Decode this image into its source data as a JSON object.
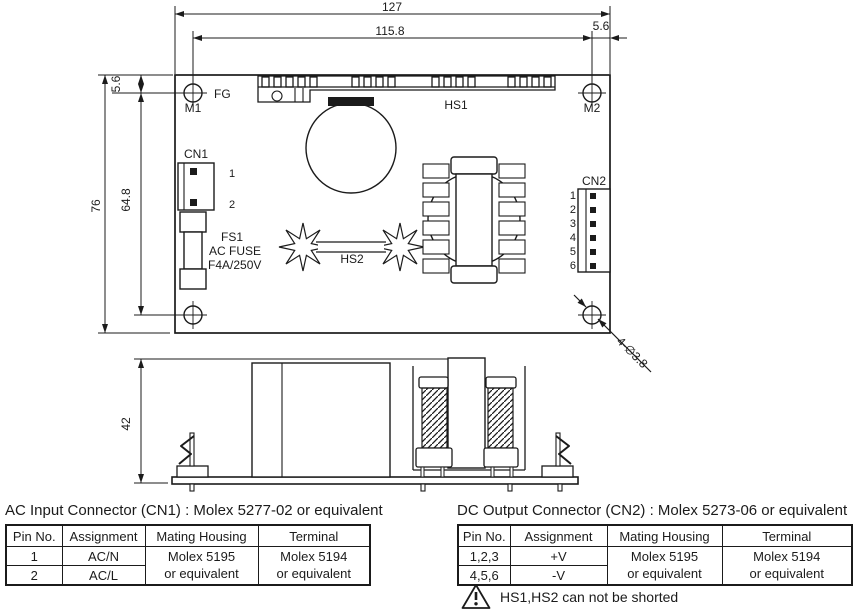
{
  "drawing": {
    "top_view": {
      "dims": {
        "total_width": "127",
        "hole_span_width": "115.8",
        "hole_offset_right": "5.6",
        "hole_offset_top": "5.6",
        "total_height": "76",
        "hole_span_height": "64.8"
      },
      "labels": {
        "fg": "FG",
        "m1": "M1",
        "m2": "M2",
        "cn1": "CN1",
        "cn2": "CN2",
        "hs1": "HS1",
        "hs2": "HS2",
        "fs1": "FS1",
        "fuse_type": "AC FUSE",
        "fuse_rating": "F4A/250V",
        "hole_callout": "4-∅3.8"
      },
      "cn1_pins": [
        "1",
        "2"
      ],
      "cn2_pins": [
        "1",
        "2",
        "3",
        "4",
        "5",
        "6"
      ]
    },
    "side_view": {
      "dims": {
        "height": "42"
      }
    }
  },
  "tables": {
    "cn1": {
      "title": "AC Input Connector (CN1) : Molex 5277-02 or equivalent",
      "headers": [
        "Pin No.",
        "Assignment",
        "Mating Housing",
        "Terminal"
      ],
      "rows": [
        {
          "pin": "1",
          "assignment": "AC/N"
        },
        {
          "pin": "2",
          "assignment": "AC/L"
        }
      ],
      "mating_housing": "Molex 5195\nor equivalent",
      "terminal": "Molex 5194\nor equivalent"
    },
    "cn2": {
      "title": "DC Output Connector (CN2) : Molex 5273-06 or equivalent",
      "headers": [
        "Pin No.",
        "Assignment",
        "Mating Housing",
        "Terminal"
      ],
      "rows": [
        {
          "pin": "1,2,3",
          "assignment": "+V"
        },
        {
          "pin": "4,5,6",
          "assignment": "-V"
        }
      ],
      "mating_housing": "Molex 5195\nor equivalent",
      "terminal": "Molex 5194\nor equivalent"
    }
  },
  "note": {
    "warning": "HS1,HS2 can not be shorted"
  },
  "colors": {
    "line": "#1b1b1b",
    "background": "#ffffff"
  }
}
